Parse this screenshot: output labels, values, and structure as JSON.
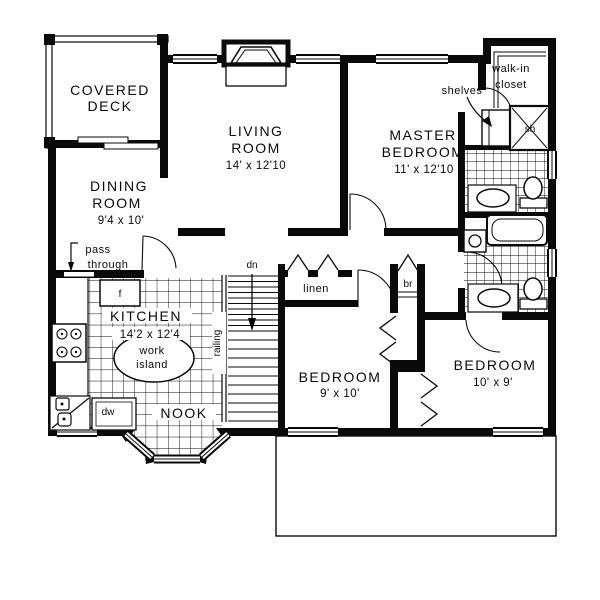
{
  "plan": {
    "rooms": {
      "covered_deck": {
        "line1": "COVERED",
        "line2": "DECK"
      },
      "living": {
        "line1": "LIVING",
        "line2": "ROOM",
        "dims": "14' x 12'10"
      },
      "master": {
        "line1": "MASTER",
        "line2": "BEDROOM",
        "dims": "11' x 12'10"
      },
      "dining": {
        "line1": "DINING",
        "line2": "ROOM",
        "dims": "9'4 x 10'"
      },
      "kitchen": {
        "name": "KITCHEN",
        "dims": "14'2 x 12'4"
      },
      "nook": {
        "name": "NOOK"
      },
      "bedroom_left": {
        "name": "BEDROOM",
        "dims": "9' x 10'"
      },
      "bedroom_right": {
        "name": "BEDROOM",
        "dims": "10' x 9'"
      },
      "walk_in_closet": {
        "line1": "walk-in",
        "line2": "closet"
      }
    },
    "labels": {
      "shelves": "shelves",
      "shower": "sh",
      "linen": "linen",
      "broom_closet": "br",
      "pass_line1": "pass",
      "pass_line2": "through",
      "work_island_line1": "work",
      "work_island_line2": "island",
      "fridge": "f",
      "dishwasher": "dw",
      "railing": "railing",
      "stairs_down": "dn"
    },
    "colors": {
      "ink": "#0a0a0a",
      "paper": "#ffffff"
    }
  }
}
